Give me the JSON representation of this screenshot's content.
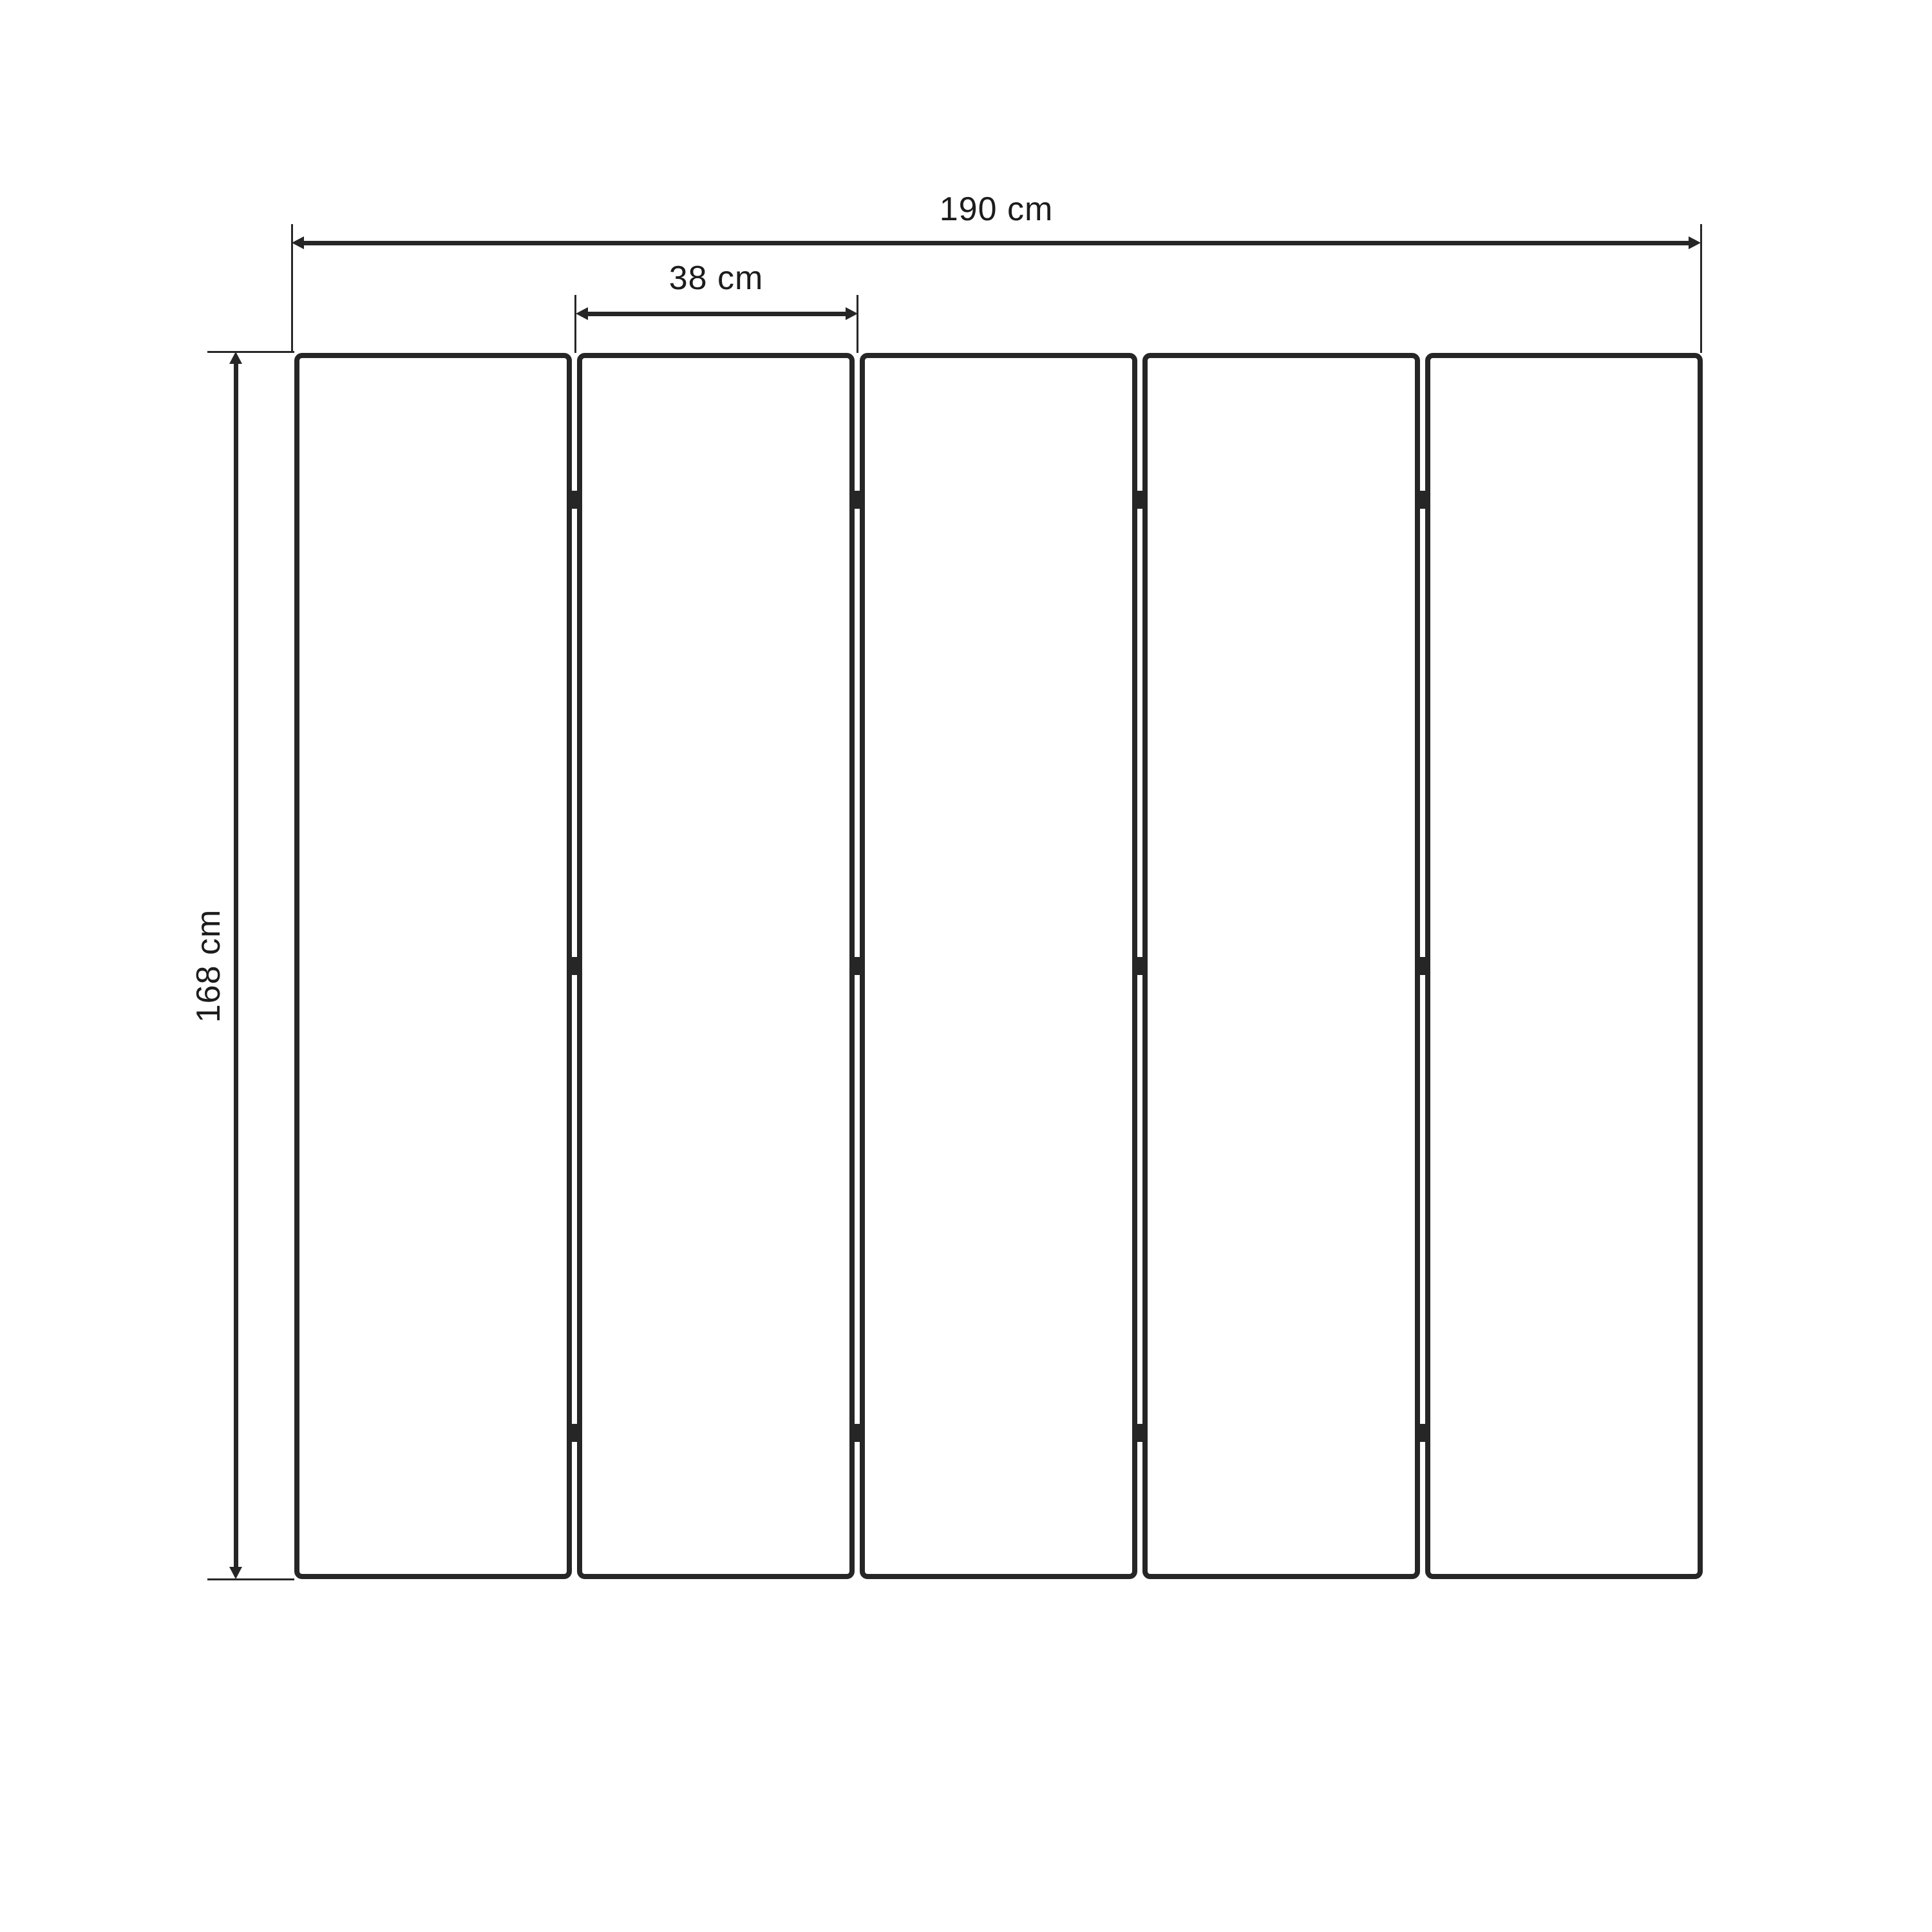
{
  "diagram": {
    "panel_count": 5,
    "gap_count": 4,
    "hinges_per_gap": 3,
    "dimensions": {
      "total_width": {
        "label": "190 cm",
        "value": 190,
        "unit": "cm"
      },
      "panel_width": {
        "label": "38 cm",
        "value": 38,
        "unit": "cm"
      },
      "height": {
        "label": "168 cm",
        "value": 168,
        "unit": "cm"
      }
    },
    "colors": {
      "line": "#262626",
      "text": "#1c1c1c",
      "background": "#ffffff"
    }
  }
}
